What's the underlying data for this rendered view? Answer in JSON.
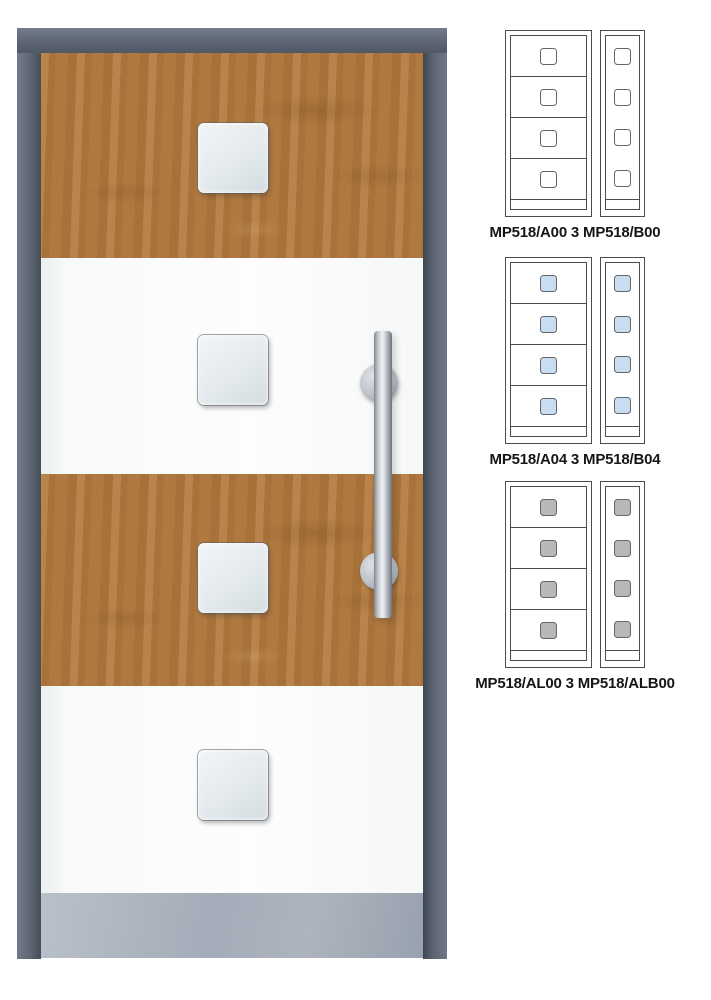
{
  "colors": {
    "background": "#ffffff",
    "frame": "#5d6672",
    "wood": "#b0793f",
    "panel_white": "#fdfdfd",
    "kick_plate": "#a4acb9",
    "glass_main": "#e4eaed",
    "diagram_line": "#4d4d4d",
    "label_text": "#161616"
  },
  "door": {
    "window_count": 4,
    "handle": "vertical-pull-bar"
  },
  "variants": [
    {
      "label": "MP518/A00 3 MP518/B00",
      "glass": "#ffffff"
    },
    {
      "label": "MP518/A04 3 MP518/B04",
      "glass": "#c9ddf0"
    },
    {
      "label": "MP518/AL00 3 MP518/ALB00",
      "glass": "#b6b8ba"
    }
  ]
}
